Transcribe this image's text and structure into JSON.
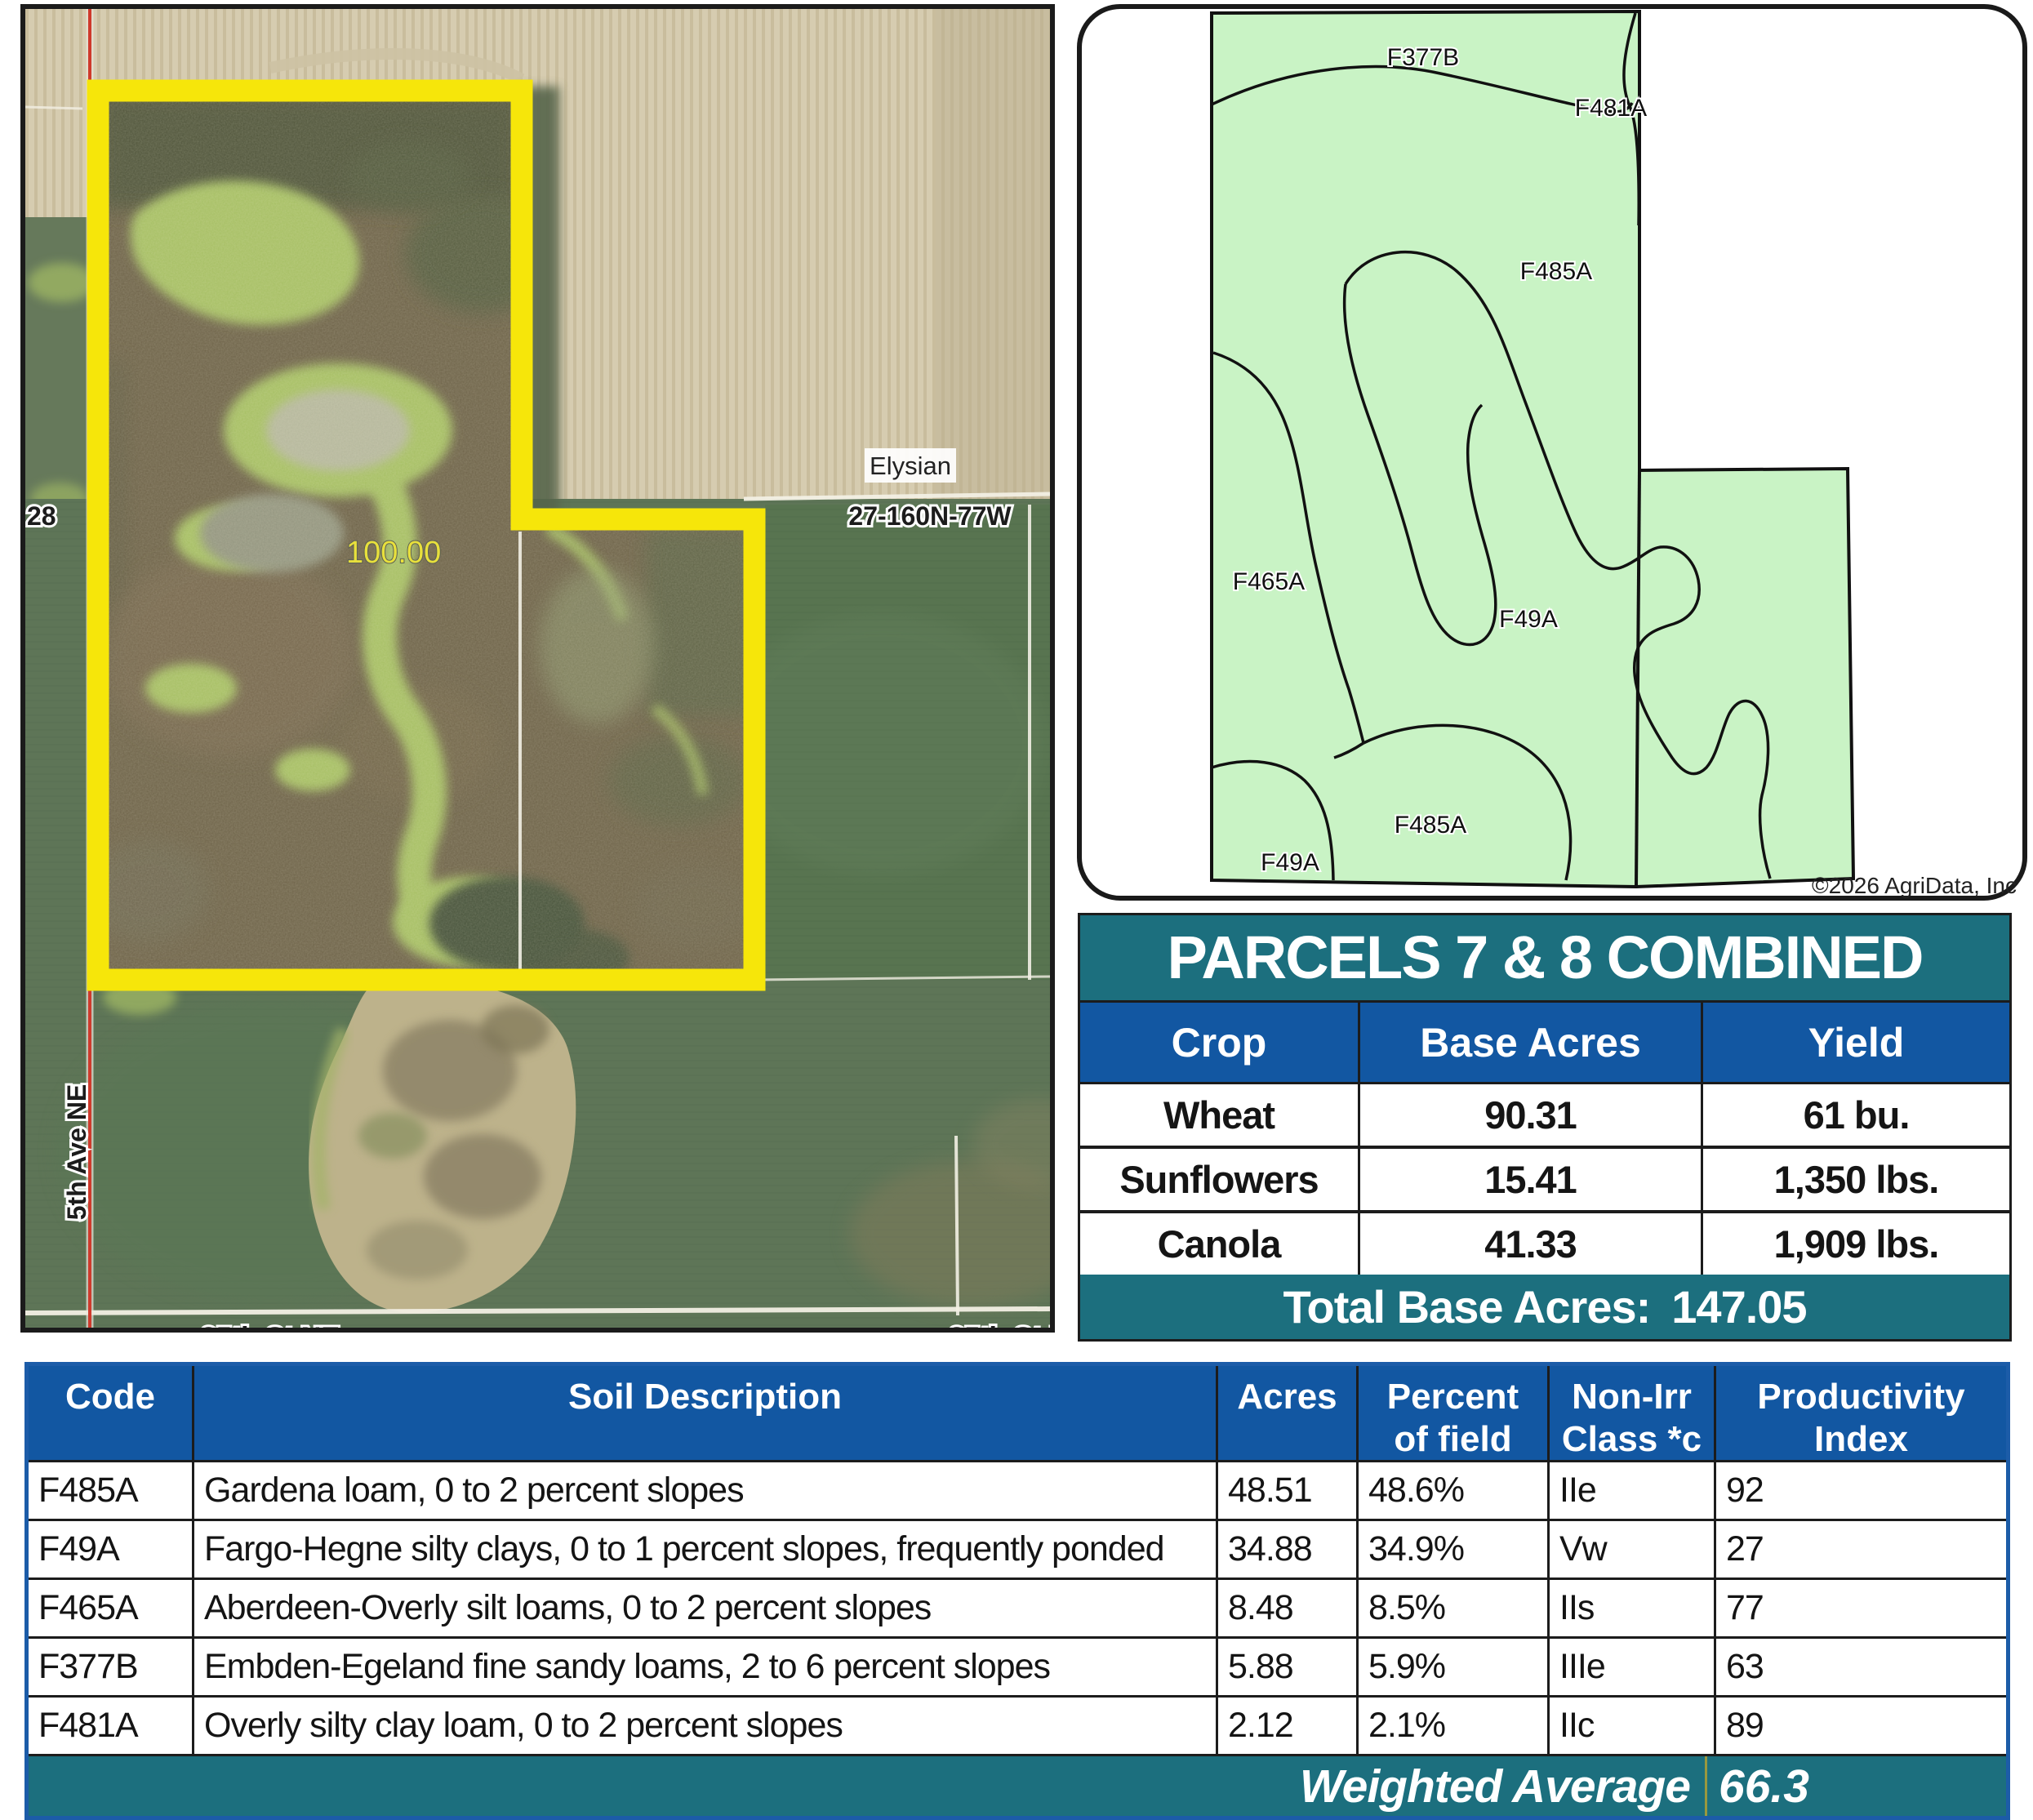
{
  "colors": {
    "teal": "#1C6F7E",
    "blue": "#1257A2",
    "boundary_yellow": "#F6E60A",
    "soil_map_green": "#C9F3C5"
  },
  "aerial_map": {
    "area_label": "100.00",
    "town_label": "Elysian",
    "trs_label": "27-160N-77W",
    "section_number": "28",
    "road_left": "5th Ave NE",
    "road_bottom_left": "85th St NE",
    "road_bottom_right": "85th St N"
  },
  "soil_map": {
    "labels": [
      {
        "text": "F377B"
      },
      {
        "text": "F481A"
      },
      {
        "text": "F485A"
      },
      {
        "text": "F465A"
      },
      {
        "text": "F49A"
      },
      {
        "text": "F485A"
      },
      {
        "text": "F49A"
      }
    ],
    "copyright": "©2026 AgriData, Inc"
  },
  "parcels_table": {
    "title": "PARCELS 7 & 8 COMBINED",
    "columns": [
      "Crop",
      "Base Acres",
      "Yield"
    ],
    "rows": [
      [
        "Wheat",
        "90.31",
        "61 bu."
      ],
      [
        "Sunflowers",
        "15.41",
        "1,350 lbs."
      ],
      [
        "Canola",
        "41.33",
        "1,909 lbs."
      ]
    ],
    "total_label": "Total Base Acres:",
    "total_value": "147.05"
  },
  "soil_table": {
    "columns": [
      "Code",
      "Soil Description",
      "Acres",
      "Percent\nof field",
      "Non-Irr\nClass *c",
      "Productivity\nIndex"
    ],
    "rows": [
      [
        "F485A",
        "Gardena loam, 0 to 2 percent slopes",
        "48.51",
        "48.6%",
        "IIe",
        "92"
      ],
      [
        "F49A",
        "Fargo-Hegne silty clays, 0 to 1 percent slopes, frequently ponded",
        "34.88",
        "34.9%",
        "Vw",
        "27"
      ],
      [
        "F465A",
        "Aberdeen-Overly silt loams, 0 to 2 percent slopes",
        "8.48",
        "8.5%",
        "IIs",
        "77"
      ],
      [
        "F377B",
        "Embden-Egeland fine sandy loams, 2 to 6 percent slopes",
        "5.88",
        "5.9%",
        "IIIe",
        "63"
      ],
      [
        "F481A",
        "Overly silty clay loam, 0 to 2 percent slopes",
        "2.12",
        "2.1%",
        "IIc",
        "89"
      ]
    ],
    "footer_label": "Weighted Average",
    "footer_value": "66.3"
  }
}
